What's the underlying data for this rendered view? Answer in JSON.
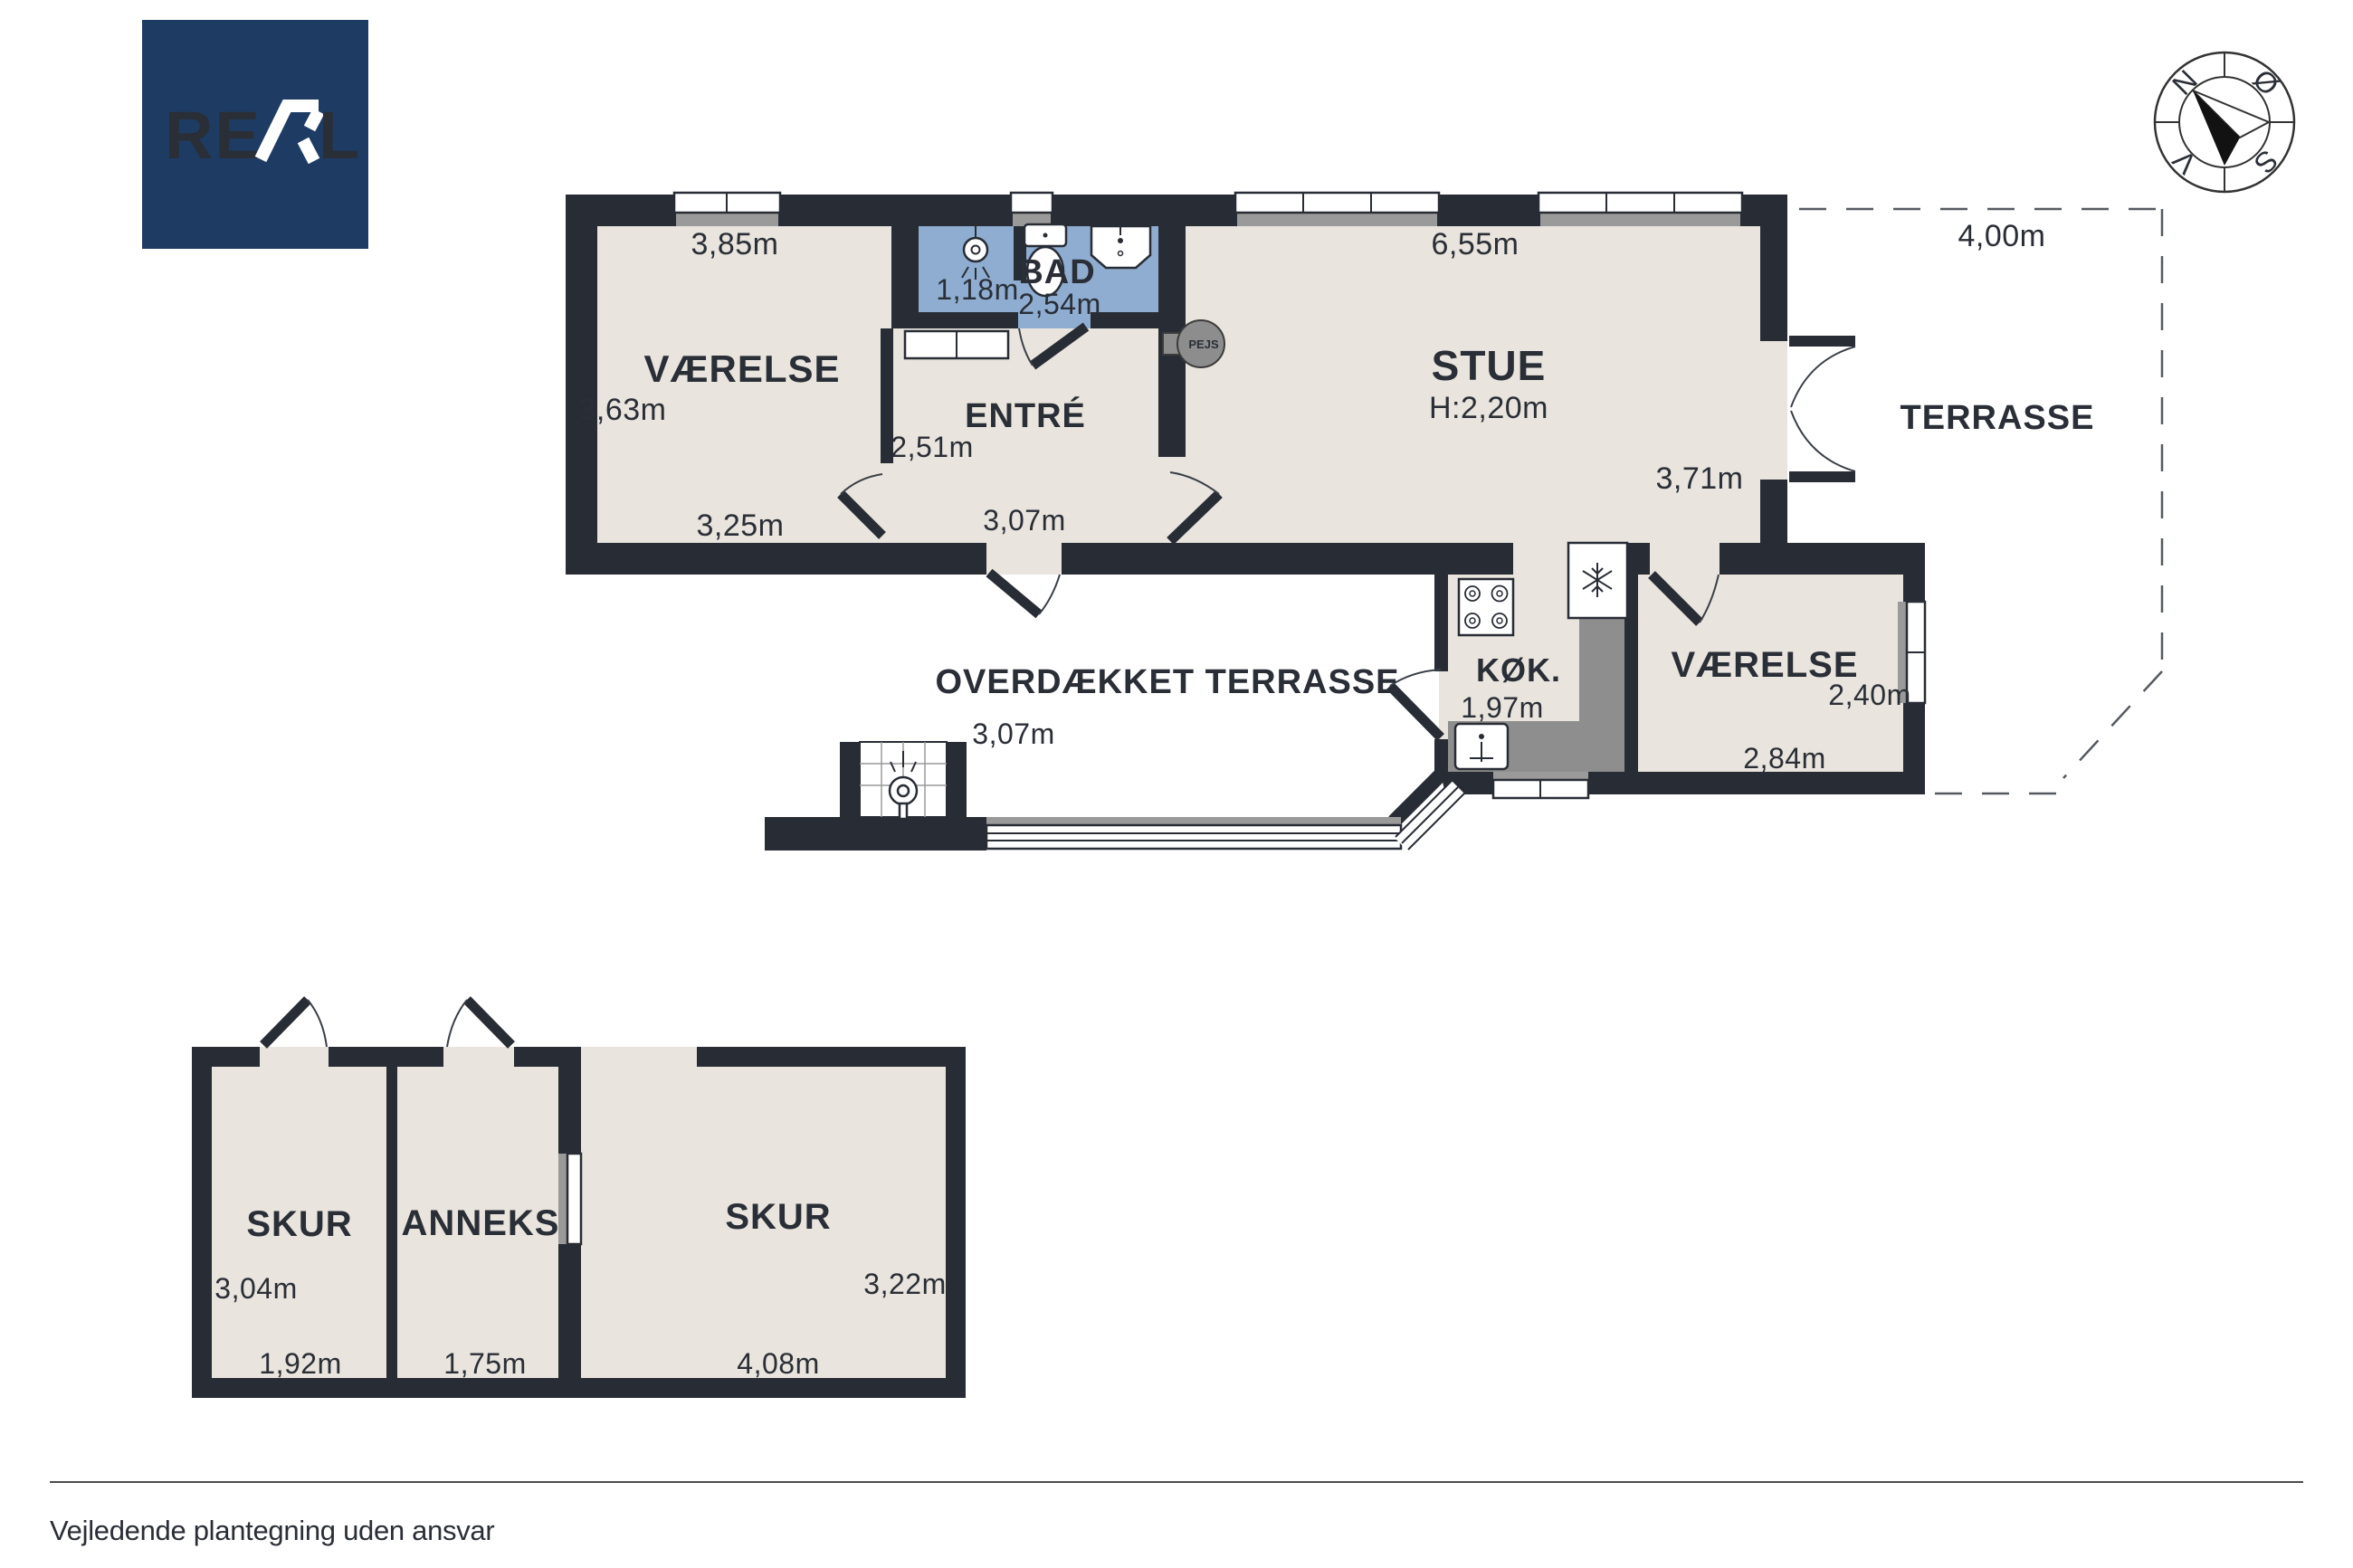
{
  "logo": {
    "brand": "REAL"
  },
  "compass": {
    "north": "N",
    "east": "Ø",
    "south": "S",
    "west": "V"
  },
  "footer": {
    "disclaimer": "Vejledende plantegning uden ansvar"
  },
  "colors": {
    "wall": "#282c35",
    "room_fill": "#e9e4dd",
    "bathroom_fill": "#8fadd1",
    "counter_gray": "#8e8e8e",
    "sill_gray": "#9a9a9a",
    "logo_bg": "#1e3c63"
  },
  "floorplan": {
    "main": {
      "vaerelse1": {
        "name": "VÆRELSE",
        "width_top": "3,85m",
        "height_left": "3,63m",
        "width_bottom": "3,25m"
      },
      "bad": {
        "name": "BAD",
        "width": "1,18m",
        "length": "2,54m"
      },
      "entre": {
        "name": "ENTRÉ",
        "width": "2,51m",
        "length": "3,07m"
      },
      "stue": {
        "name": "STUE",
        "ceiling_height": "H:2,20m",
        "width_top": "6,55m",
        "height_right": "3,71m",
        "fireplace": "PEJS"
      },
      "koekken": {
        "name": "KØK.",
        "width": "1,97m"
      },
      "vaerelse2": {
        "name": "VÆRELSE",
        "height_right": "2,40m",
        "width_bottom": "2,84m"
      },
      "terrasse": {
        "name": "TERRASSE",
        "width_top": "4,00m"
      },
      "overdaekket_terrasse": {
        "name": "OVERDÆKKET TERRASSE",
        "width": "3,07m"
      }
    },
    "outbuilding": {
      "skur1": {
        "name": "SKUR",
        "height_left": "3,04m",
        "width_bottom": "1,92m"
      },
      "anneks": {
        "name": "ANNEKS",
        "width_bottom": "1,75m"
      },
      "skur2": {
        "name": "SKUR",
        "height_right": "3,22m",
        "width_bottom": "4,08m"
      }
    }
  }
}
